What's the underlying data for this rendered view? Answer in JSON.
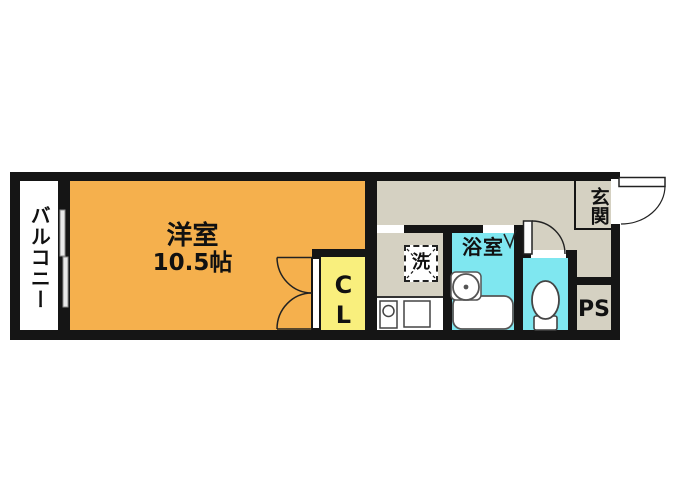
{
  "floorplan": {
    "type": "japanese-apartment-floorplan",
    "balcony": {
      "label": "バルコニー"
    },
    "main_room": {
      "label": "洋室",
      "size": "10.5帖"
    },
    "closet": {
      "label": "CL"
    },
    "laundry": {
      "label": "洗"
    },
    "bathroom": {
      "label": "浴室"
    },
    "entrance": {
      "label": "玄関"
    },
    "pipe_space": {
      "label": "PS"
    },
    "colors": {
      "main_room": "#F5B04D",
      "closet": "#F9EF7D",
      "wet_area": "#7FE7F0",
      "hallway": "#D5D1C2",
      "wall": "#151515",
      "background": "#FFFFFF"
    }
  }
}
